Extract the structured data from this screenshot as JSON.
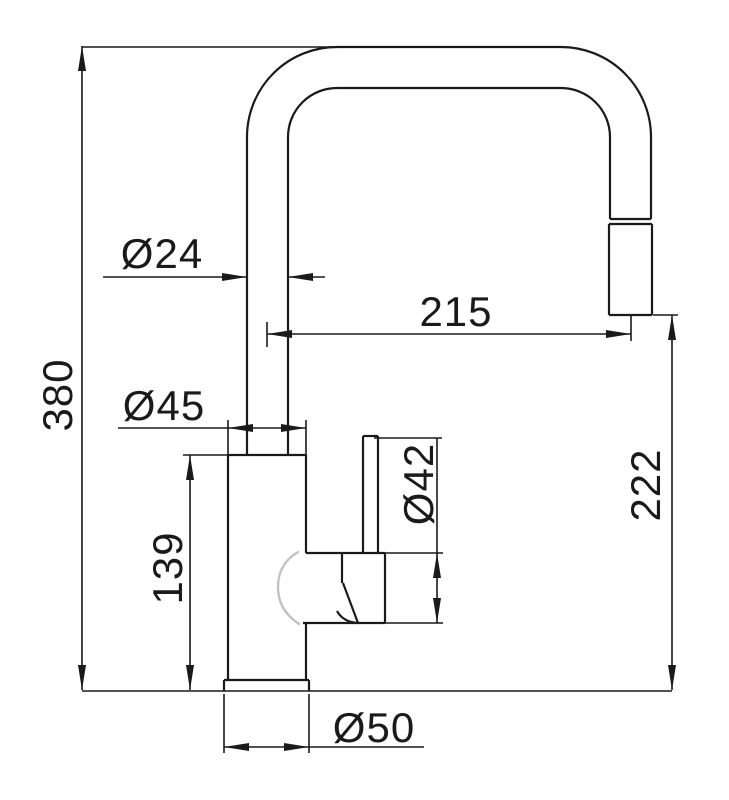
{
  "page": {
    "background": "#ffffff",
    "line_color": "#1a1a1a",
    "soft_line_color": "#c2c2c2"
  },
  "labels": {
    "total_height": "380",
    "spout_tube_diameter": "Ø24",
    "spout_reach": "215",
    "body_diameter": "Ø45",
    "cartridge_diameter": "Ø42",
    "body_height": "139",
    "outlet_height": "222",
    "base_diameter": "Ø50"
  }
}
